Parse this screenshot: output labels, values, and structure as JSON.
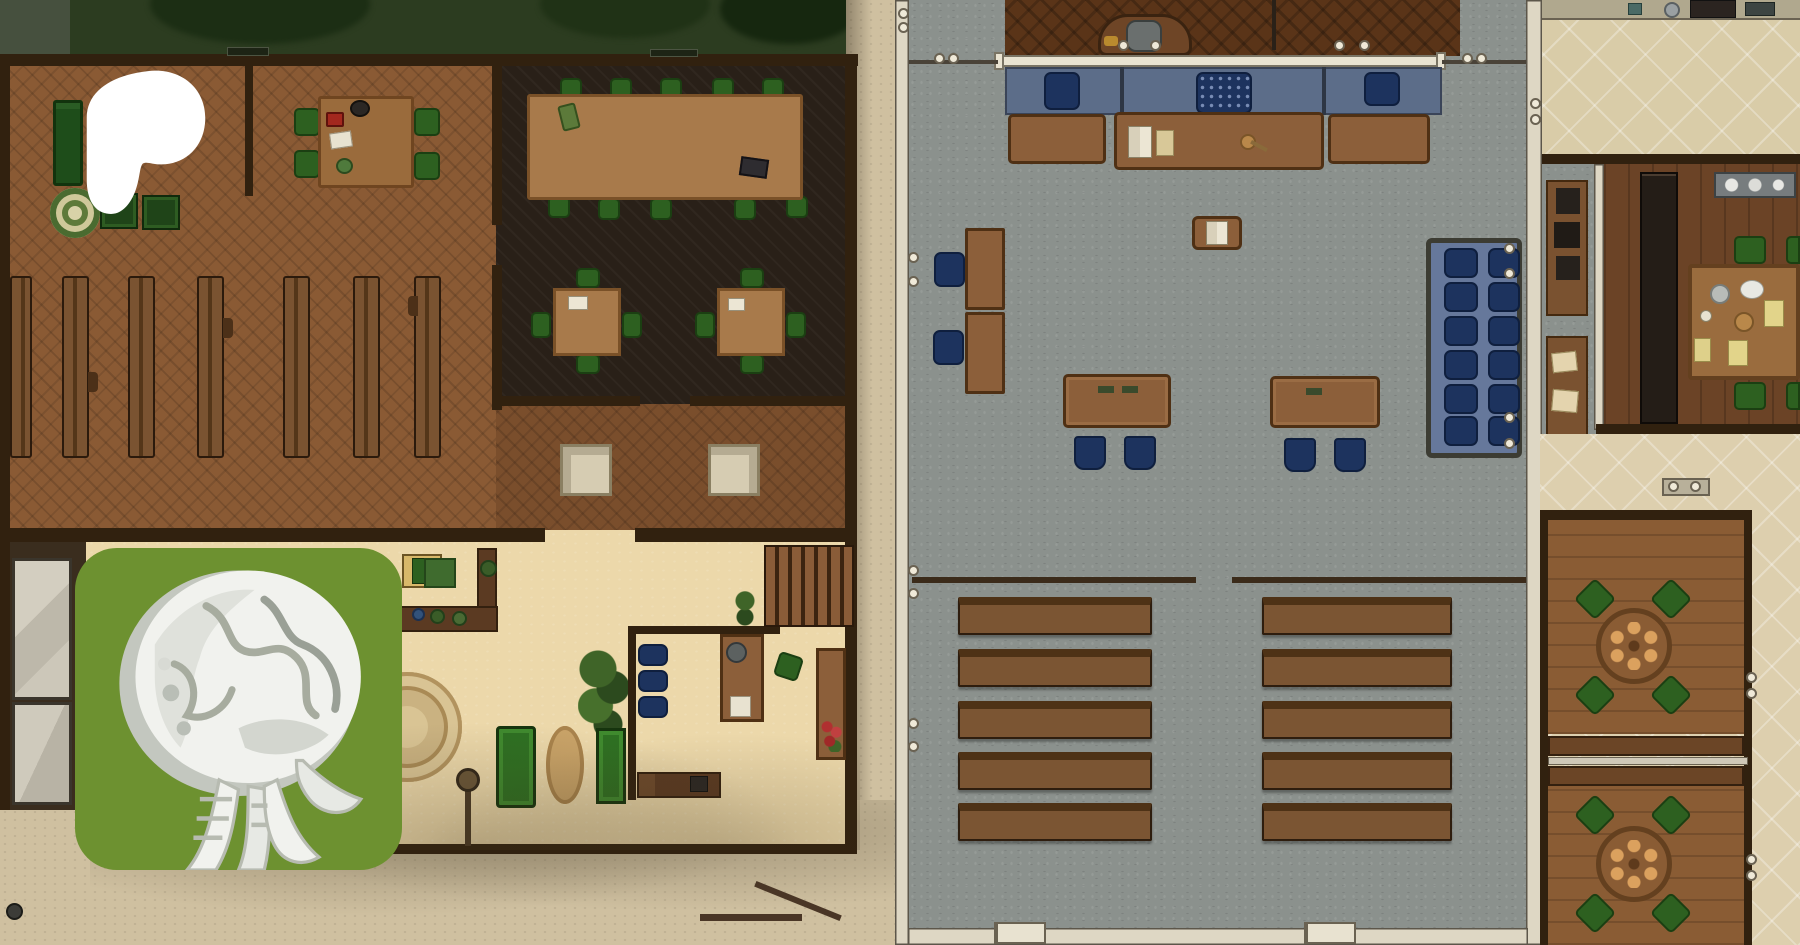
{
  "scene": {
    "name": "Courthouse battlemap",
    "description": "Top-down tabletop RPG battlemap showing a wooden meeting hall with pews, a tan lobby with office, a stone-floored courtroom with judge's bench, jury box and gallery benches, and a restaurant wing with kitchen, dining room and two private round-table rooms",
    "grid_visible": false
  },
  "overlays": {
    "patreon_logo": {
      "icon": "patreon-blob",
      "color": "#ffffff"
    },
    "creator_badge": {
      "icon": "brain-tentacle-creature",
      "background": "#6d9130",
      "figure_color": "#f1f2ee"
    }
  },
  "left_building": {
    "name": "Meeting hall and lobby",
    "bedroom_corner": {
      "bed_count": 1,
      "crate_count": 2,
      "round_rug_count": 1
    },
    "corner_table": {
      "chair_count": 4,
      "items_on_table": [
        "red chest",
        "black pot",
        "white paper",
        "green mug"
      ]
    },
    "hall": {
      "pew_count": 7,
      "pew_orientation": "vertical"
    },
    "lounge": {
      "long_table_count": 1,
      "long_table_chairs": 10,
      "card_table_count": 2,
      "card_table_chairs_each": 4,
      "items": [
        "green satchel",
        "dark case",
        "white card"
      ]
    },
    "study": {
      "white_table_count": 2
    },
    "lobby": {
      "reception_counter": 1,
      "plants": 3,
      "round_ornate_rug": 1,
      "oval_rug": 1,
      "green_benches": 2,
      "stairs": 1,
      "lamp_post": 1
    },
    "office": {
      "waiting_chairs": 3,
      "desks": 2,
      "desk_chair": 1,
      "green_chair": 1,
      "flower_vase": 1,
      "cabinet": 1
    },
    "wall_signs": [
      {
        "position": "north-west",
        "legible": false
      },
      {
        "position": "north-east",
        "legible": false
      }
    ]
  },
  "courthouse": {
    "name": "Courtroom",
    "judge_dais": {
      "bench_seats": 3,
      "seat_color": "navy",
      "desk_items": [
        "open book",
        "papers",
        "gavel"
      ],
      "railing": "cream"
    },
    "witness_clerk_boxes": {
      "count": 2,
      "chairs": 2
    },
    "lectern": {
      "count": 1,
      "item": "open book"
    },
    "attorney_tables": {
      "count": 2,
      "chairs_each": 2
    },
    "jury_box": {
      "rows": 6,
      "columns": 2,
      "seats": 12,
      "seat_color": "navy",
      "platform_color": "blue-gray"
    },
    "gallery": {
      "bench_columns": 2,
      "bench_rows": 5,
      "total_benches": 10
    },
    "doors": {
      "south_double_doors": 2,
      "west_door_hardware_pairs": 3,
      "east_door_hardware_pairs": 1,
      "gate_rings_north": 2
    }
  },
  "right_building": {
    "name": "Restaurant wing",
    "kitchen": {
      "floor": "diagonal tile",
      "counter_items": [
        "stove",
        "pots",
        "dishes"
      ]
    },
    "corridor": {
      "sideboards": 2,
      "sideboard_items": [
        "dark boxes",
        "papers"
      ]
    },
    "dining_room": {
      "table_count": 1,
      "chair_count": 4,
      "place_settings": [
        "plates",
        "yellow placemats",
        "white dishes"
      ],
      "bookshelf": 1,
      "sideboard": 1
    },
    "private_rooms": {
      "count": 2,
      "round_tables_each": 1,
      "chairs_each": 4,
      "plates_per_table": 6,
      "divider_benches": 2
    }
  },
  "annex": {
    "name": "Canvas cells",
    "tarp_structures": 2
  },
  "palette": {
    "hall_wood": "#8a5a34",
    "lounge_dark": "#292018",
    "stone_gray": "#8b918d",
    "lobby_tan": "#ecd8aa",
    "street_tan": "#cfc0a0",
    "kitchen_tile": "#d9cca8",
    "navy_chair": "#1d335e",
    "judge_platform_blue": "#5c6d89",
    "jury_platform": "#66789b",
    "green_chair": "#2d6020",
    "bench_brown": "#7b5533",
    "wall_dark": "#31210f",
    "wall_cream": "#ded7c4",
    "badge_green": "#6d9130",
    "logo_white": "#ffffff",
    "foliage_dark": "#2c3c20"
  }
}
